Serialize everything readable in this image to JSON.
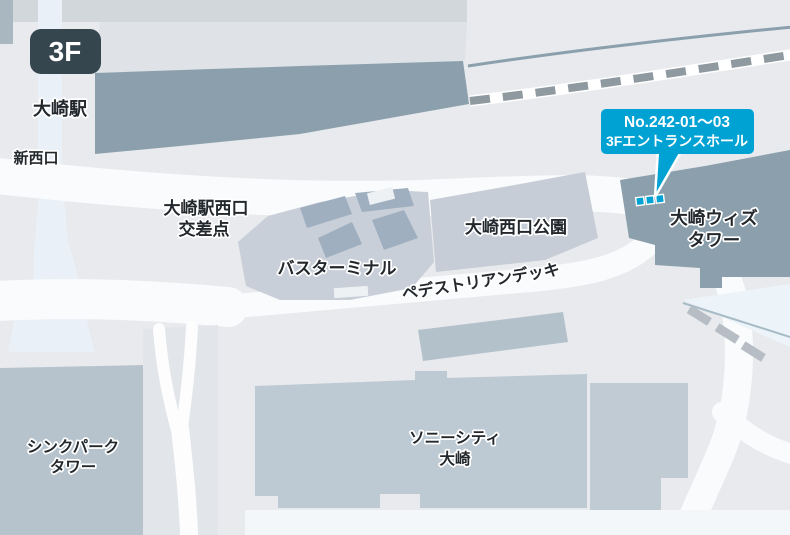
{
  "map": {
    "floor_badge": "3F",
    "labels": {
      "station": "大崎駅",
      "new_west_exit": "新西口",
      "crossing_line1": "大崎駅西口",
      "crossing_line2": "交差点",
      "bus_terminal": "バスターミナル",
      "park": "大崎西口公園",
      "pedestrian_deck": "ペデストリアンデッキ",
      "wiz_tower_line1": "大崎ウィズ",
      "wiz_tower_line2": "タワー",
      "think_park_line1": "シンクパーク",
      "think_park_line2": "タワー",
      "sony_city_line1": "ソニーシティ",
      "sony_city_line2": "大崎"
    },
    "callout": {
      "line1": "No.242-01～03",
      "line2": "3Fエントランスホール"
    },
    "markers": {
      "entrance_squares_count": 3
    },
    "colors": {
      "background": "#e8eaed",
      "accent_cyan": "#00a2d4",
      "badge_bg": "#36464f",
      "building_dark": "#8ba0ac",
      "building_medium": "#becad3",
      "building_light": "#c8cfd8",
      "road_white": "#fafbfc",
      "walkway_pale_blue": "#e9f0f7"
    }
  }
}
